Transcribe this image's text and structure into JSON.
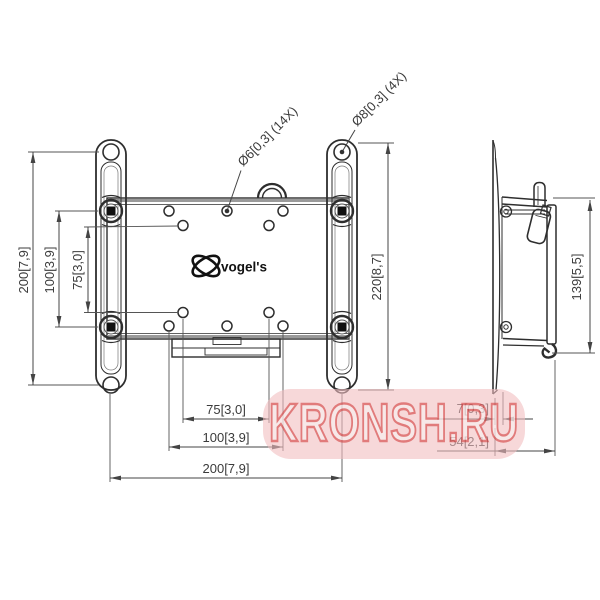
{
  "drawing": {
    "type": "tv-wall-mount-technical-drawing",
    "front": {
      "label_plate_holes": "Ø6[0,3] (14X)",
      "label_wall_holes": "Ø8[0,3] (4X)",
      "dim_left_outer": "200[7,9]",
      "dim_left_mid": "100[3,9]",
      "dim_left_inner": "75[3,0]",
      "dim_right_height": "220[8,7]",
      "dim_bottom_inner": "75[3,0]",
      "dim_bottom_mid": "100[3,9]",
      "dim_bottom_outer": "200[7,9]"
    },
    "side": {
      "dim_height": "139[5,5]",
      "dim_thickness": "7[0,3]",
      "dim_depth": "54[2,1]"
    }
  },
  "logo": {
    "text": "vogel's"
  },
  "watermark": {
    "text": "KRONSH.RU"
  },
  "colors": {
    "line": "#2e2e2e",
    "dim_text": "#3b3b3b",
    "plate_edge": "#9a9a9a",
    "watermark_blob": "#f1bcbf",
    "watermark_fill": "#f6e3e3",
    "watermark_stroke": "#db5f5f"
  }
}
